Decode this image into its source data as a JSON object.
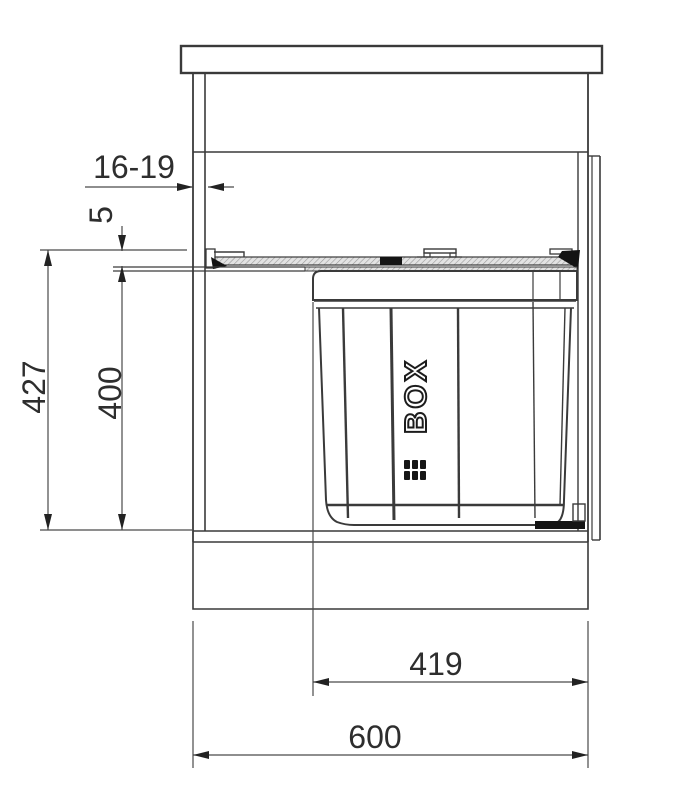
{
  "drawing": {
    "type": "technical-drawing",
    "subject": "built-in pull-out waste bin inside kitchen cabinet, section view with dimensions",
    "colors": {
      "background": "#ffffff",
      "structure_line": "#3a3a3a",
      "dimension_line": "#4a4a4a",
      "text": "#2e2e2e",
      "dark_fill": "#141414",
      "hatch_fill": "#dedede"
    },
    "dimensions": {
      "panel_thickness_mm": "16-19",
      "top_gap_mm": "5",
      "overall_height_mm": "427",
      "bin_unit_height_mm": "400",
      "bin_unit_width_mm": "419",
      "cabinet_width_mm": "600"
    },
    "bin_logo_text": "BOX"
  }
}
